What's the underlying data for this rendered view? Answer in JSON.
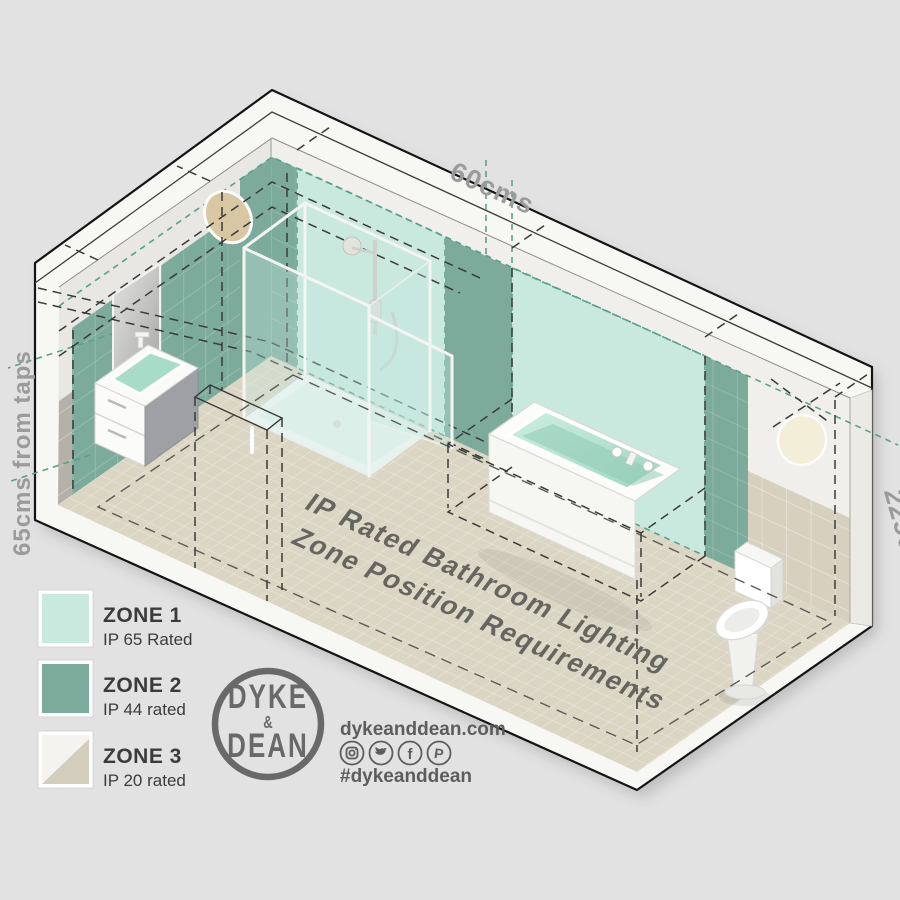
{
  "diagram": {
    "title_line1": "IP Rated Bathroom Lighting",
    "title_line2": "Zone Position Requirements",
    "dimensions": {
      "top_width": "60cms",
      "left_height": "65cms from taps",
      "right_height": "225cms"
    }
  },
  "legend": {
    "items": [
      {
        "zone": "ZONE 1",
        "rating": "IP 65 Rated",
        "color": "#c9e9df"
      },
      {
        "zone": "ZONE 2",
        "rating": "IP 44 rated",
        "color": "#7dab9b"
      },
      {
        "zone": "ZONE 3",
        "rating": "IP 20 rated",
        "color": "#d3cdbd"
      }
    ]
  },
  "brand": {
    "logo_top": "DYKE",
    "logo_amp": "&",
    "logo_bottom": "DEAN",
    "website": "dykeanddean.com",
    "hashtag": "#dykeanddean",
    "social_icons": [
      "instagram",
      "twitter",
      "facebook",
      "pinterest"
    ]
  },
  "colors": {
    "background": "#e2e2e2",
    "zone1_mint": "#c9e9df",
    "zone2_green": "#7dab9b",
    "zone3_beige": "#d3cdbd",
    "teal_dashes": "#5ba08c",
    "floor_tile": "#dbd5c4",
    "label_gray": "#9b9b9b",
    "brand_gray": "#5d5d5d"
  }
}
